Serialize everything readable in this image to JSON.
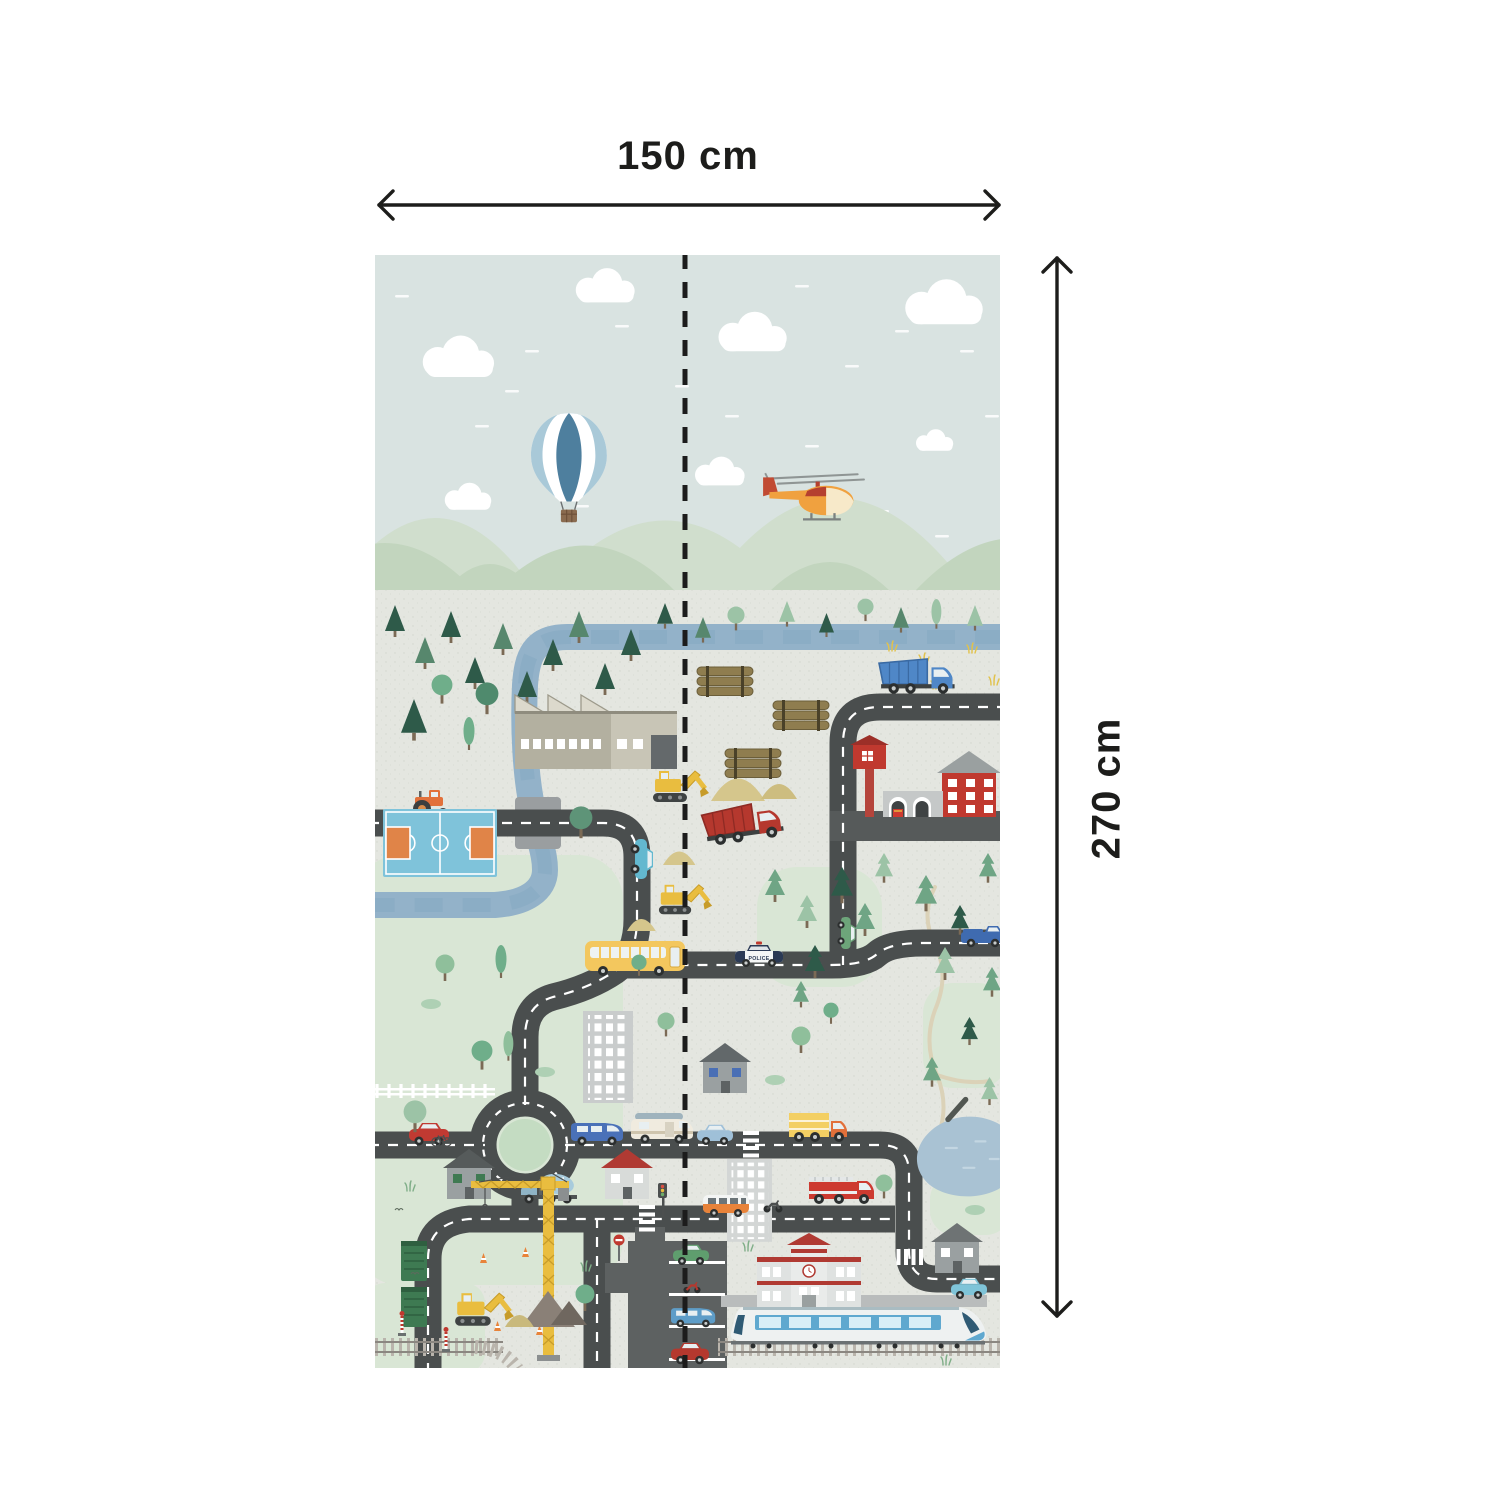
{
  "dimension_annotations": {
    "width_label": "150 cm",
    "height_label": "270 cm",
    "arrow_color": "#1d1d1b"
  },
  "mural": {
    "police_label": "POLICE",
    "palette": {
      "sky": "#d9e3e1",
      "cloud": "#ffffff",
      "mountain-pale": "#d0decd",
      "mountain-mid": "#c2d5be",
      "ground": "#e4e6e0",
      "grass-patch": "#d9e6d5",
      "river": "#93b2c9",
      "river-streak": "#7fa3bd",
      "road": "#4a4e4e",
      "road-line": "#ffffff",
      "plaza": "#5d6161",
      "street": "#565a5a",
      "bridge": "#9a9ea0",
      "rail-tie": "#b9b4ac",
      "rail": "#8b8781",
      "platform": "#b9bcbc",
      "dirt-path": "#dbd2b8",
      "fold-line": "#1c1c1c"
    },
    "scene": [
      {
        "n": "cloud",
        "s": "cloud",
        "x": 42,
        "y": 84,
        "sc": 1.15
      },
      {
        "n": "cloud",
        "s": "cloud",
        "x": 196,
        "y": 16,
        "sc": 0.95
      },
      {
        "n": "cloud",
        "s": "cloud",
        "x": 338,
        "y": 60,
        "sc": 1.1
      },
      {
        "n": "cloud",
        "s": "cloud",
        "x": 524,
        "y": 28,
        "sc": 1.25
      },
      {
        "n": "cloud",
        "s": "cloud",
        "x": 66,
        "y": 230,
        "sc": 0.75
      },
      {
        "n": "cloud",
        "s": "cloud",
        "x": 316,
        "y": 204,
        "sc": 0.8
      },
      {
        "n": "cloud",
        "s": "cloud",
        "x": 538,
        "y": 176,
        "sc": 0.6
      },
      {
        "n": "hot-air-balloon",
        "s": "balloon",
        "x": 156,
        "y": 158,
        "sc": 1.15
      },
      {
        "n": "helicopter",
        "s": "heli",
        "x": 386,
        "y": 214,
        "sc": 1.05
      },
      {
        "n": "pine-tree",
        "s": "pine",
        "x": 10,
        "y": 350
      },
      {
        "n": "pine-tree",
        "s": "pine",
        "x": 40,
        "y": 382,
        "c1": "#57876d"
      },
      {
        "n": "pine-tree",
        "s": "pine",
        "x": 66,
        "y": 356
      },
      {
        "n": "pine-tree",
        "s": "pine",
        "x": 90,
        "y": 402
      },
      {
        "n": "pine-tree",
        "s": "pine",
        "x": 118,
        "y": 368,
        "c1": "#57876d"
      },
      {
        "n": "pine-tree",
        "s": "pine",
        "x": 142,
        "y": 416
      },
      {
        "n": "pine-tree",
        "s": "pine",
        "x": 168,
        "y": 384
      },
      {
        "n": "pine-tree",
        "s": "pine",
        "x": 194,
        "y": 356,
        "c1": "#57876d"
      },
      {
        "n": "pine-tree",
        "s": "pine",
        "x": 220,
        "y": 408
      },
      {
        "n": "pine-tree",
        "s": "pine",
        "x": 246,
        "y": 374
      },
      {
        "n": "pine-tree",
        "s": "pine",
        "x": 26,
        "y": 444,
        "sc": 1.3
      },
      {
        "n": "pine-tree",
        "s": "pine",
        "x": 148,
        "y": 466,
        "sc": 1.3
      },
      {
        "n": "pine-tree",
        "s": "pine",
        "x": 238,
        "y": 466,
        "sc": 1.2
      },
      {
        "n": "pine-tree",
        "s": "pine",
        "x": 204,
        "y": 452,
        "c1": "#57876d"
      },
      {
        "n": "round-tree",
        "s": "tree",
        "x": 56,
        "y": 420,
        "c1": "#6fae8a",
        "sc": 1.1
      },
      {
        "n": "round-tree",
        "s": "tree",
        "x": 100,
        "y": 428,
        "c1": "#4f8a6d",
        "sc": 1.2
      },
      {
        "n": "cypress-tree",
        "s": "cypress",
        "x": 88,
        "y": 462
      },
      {
        "n": "pine-tree",
        "s": "pine",
        "x": 282,
        "y": 348,
        "sc": 0.8
      },
      {
        "n": "pine-tree",
        "s": "pine",
        "x": 320,
        "y": 362,
        "sc": 0.8,
        "c1": "#57876d"
      },
      {
        "n": "round-tree",
        "s": "tree",
        "x": 352,
        "y": 352,
        "c1": "#9cc3a6",
        "sc": 0.9
      },
      {
        "n": "pine-tree",
        "s": "pine",
        "x": 404,
        "y": 346,
        "sc": 0.8,
        "c1": "#9cc3a6"
      },
      {
        "n": "pine-tree",
        "s": "pine",
        "x": 444,
        "y": 358,
        "sc": 0.75
      },
      {
        "n": "round-tree",
        "s": "tree",
        "x": 482,
        "y": 344,
        "c1": "#9cc3a6",
        "sc": 0.85
      },
      {
        "n": "pine-tree",
        "s": "pine",
        "x": 518,
        "y": 352,
        "sc": 0.8,
        "c1": "#57876d"
      },
      {
        "n": "cypress-tree",
        "s": "cypress",
        "x": 556,
        "y": 344,
        "sc": 0.9,
        "c1": "#9cc3a6"
      },
      {
        "n": "pine-tree",
        "s": "pine",
        "x": 592,
        "y": 350,
        "sc": 0.8,
        "c1": "#9cc3a6"
      },
      {
        "n": "wheat-tuft",
        "s": "grass",
        "x": 512,
        "y": 386,
        "c1": "#e2c24a"
      },
      {
        "n": "wheat-tuft",
        "s": "grass",
        "x": 544,
        "y": 398,
        "c1": "#e2c24a"
      },
      {
        "n": "wheat-tuft",
        "s": "grass",
        "x": 592,
        "y": 388,
        "c1": "#e2c24a"
      },
      {
        "n": "wheat-tuft",
        "s": "grass",
        "x": 614,
        "y": 420,
        "c1": "#e2c24a"
      },
      {
        "n": "wheat-tuft",
        "s": "grass",
        "x": 556,
        "y": 424,
        "c1": "#e2c24a"
      },
      {
        "n": "factory",
        "s": "factory",
        "x": 140,
        "y": 428
      },
      {
        "n": "log-pile",
        "s": "logs",
        "x": 322,
        "y": 412
      },
      {
        "n": "log-pile",
        "s": "logs",
        "x": 398,
        "y": 446
      },
      {
        "n": "log-pile",
        "s": "logs",
        "x": 350,
        "y": 494
      },
      {
        "n": "dump-truck-blue",
        "s": "dumptruck",
        "x": 504,
        "y": 404,
        "sc": 1.05,
        "c1": "#4f87c7",
        "c2": "#3a6aa3"
      },
      {
        "n": "tractor",
        "s": "tractor",
        "x": 36,
        "y": 536
      },
      {
        "n": "fire-station",
        "s": "firestation",
        "x": 470,
        "y": 484
      },
      {
        "n": "backhoe-loader",
        "s": "excavator",
        "x": 276,
        "y": 512
      },
      {
        "n": "sand-pile",
        "s": "sand",
        "x": 336,
        "y": 516,
        "sc": 1.5,
        "c1": "#d5c68c"
      },
      {
        "n": "sand-pile",
        "s": "sand",
        "x": 386,
        "y": 524,
        "c1": "#cdbd80"
      },
      {
        "n": "dump-truck-red",
        "s": "dumptruck",
        "x": 326,
        "y": 556,
        "r": -8,
        "sc": 1.1,
        "c1": "#b5382e",
        "c2": "#8e2b24"
      },
      {
        "n": "sand-pile",
        "s": "sand",
        "x": 288,
        "y": 592,
        "sc": 0.9,
        "c1": "#d5c68c"
      },
      {
        "n": "excavator",
        "s": "excavator",
        "x": 282,
        "y": 626,
        "sc": 0.95
      },
      {
        "n": "sand-pile",
        "s": "sand",
        "x": 252,
        "y": 660,
        "sc": 0.8,
        "c1": "#d5c68c"
      },
      {
        "n": "basketball-court",
        "s": "court",
        "x": 8,
        "y": 554
      },
      {
        "n": "round-tree",
        "s": "tree",
        "x": 194,
        "y": 552,
        "c1": "#5e9478",
        "sc": 1.2
      },
      {
        "n": "car-teal",
        "s": "car",
        "x": 280,
        "y": 584,
        "r": 90,
        "c1": "#63b8cf"
      },
      {
        "n": "cypress-tree",
        "s": "cypress",
        "x": 120,
        "y": 690,
        "c1": "#6fae8a"
      },
      {
        "n": "round-tree",
        "s": "tree",
        "x": 60,
        "y": 700,
        "c1": "#8fbf9b"
      },
      {
        "n": "pine-tree",
        "s": "pine2",
        "x": 390,
        "y": 614,
        "c1": "#6fa585"
      },
      {
        "n": "pine-tree",
        "s": "pine2",
        "x": 422,
        "y": 640,
        "c1": "#9cc3a6"
      },
      {
        "n": "pine-tree",
        "s": "pine2",
        "x": 456,
        "y": 612,
        "c1": "#2e5a49",
        "sc": 1.1
      },
      {
        "n": "pine-tree",
        "s": "pine2",
        "x": 480,
        "y": 648,
        "c1": "#6fa585"
      },
      {
        "n": "pine-tree",
        "s": "pine2",
        "x": 430,
        "y": 690,
        "c1": "#2e5a49"
      },
      {
        "n": "pine-tree",
        "s": "pine2",
        "x": 500,
        "y": 598,
        "c1": "#9cc3a6",
        "sc": 0.9
      },
      {
        "n": "pine-tree",
        "s": "pine2",
        "x": 540,
        "y": 620,
        "c1": "#6fa585",
        "sc": 1.1
      },
      {
        "n": "pine-tree",
        "s": "pine2",
        "x": 576,
        "y": 650,
        "c1": "#2e5a49",
        "sc": 0.9
      },
      {
        "n": "pine-tree",
        "s": "pine2",
        "x": 604,
        "y": 598,
        "c1": "#6fa585",
        "sc": 0.9
      },
      {
        "n": "pine-tree",
        "s": "pine2",
        "x": 560,
        "y": 692,
        "c1": "#9cc3a6"
      },
      {
        "n": "pine-tree",
        "s": "pine2",
        "x": 608,
        "y": 712,
        "c1": "#6fa585",
        "sc": 0.9
      },
      {
        "n": "pine-tree",
        "s": "pine2",
        "x": 586,
        "y": 762,
        "c1": "#2e5a49",
        "sc": 0.85
      },
      {
        "n": "pine-tree",
        "s": "pine2",
        "x": 548,
        "y": 802,
        "c1": "#6fa585",
        "sc": 0.9
      },
      {
        "n": "pine-tree",
        "s": "pine2",
        "x": 606,
        "y": 822,
        "c1": "#9cc3a6",
        "sc": 0.85
      },
      {
        "n": "pine-tree",
        "s": "pine2",
        "x": 418,
        "y": 726,
        "c1": "#6fa585",
        "sc": 0.8
      },
      {
        "n": "school-bus",
        "s": "bus",
        "x": 210,
        "y": 686
      },
      {
        "n": "police-car",
        "s": "police",
        "x": 360,
        "y": 688
      },
      {
        "n": "pickup-truck-blue",
        "s": "pickup",
        "x": 586,
        "y": 668,
        "c1": "#3f6bb0"
      },
      {
        "n": "mini-van-green",
        "s": "car",
        "x": 482,
        "y": 662,
        "r": 90,
        "c1": "#6da57a",
        "sc": 0.8
      },
      {
        "n": "office-building",
        "s": "office",
        "x": 208,
        "y": 756,
        "c1": "#c9cccc"
      },
      {
        "n": "house-blue-windows",
        "s": "house",
        "x": 324,
        "y": 788,
        "c1": "#9aa0a1",
        "c2": "#62686a",
        "c3": "#4a6fb5"
      },
      {
        "n": "round-tree",
        "s": "tree",
        "x": 282,
        "y": 758,
        "c1": "#8fbf9b",
        "sc": 0.9
      },
      {
        "n": "round-tree",
        "s": "tree",
        "x": 256,
        "y": 700,
        "c1": "#6fae8a",
        "sc": 0.8
      },
      {
        "n": "bush",
        "s": "bush",
        "x": 390,
        "y": 820
      },
      {
        "n": "round-tree",
        "s": "tree",
        "x": 416,
        "y": 772,
        "c1": "#8fbf9b"
      },
      {
        "n": "round-tree",
        "s": "tree",
        "x": 448,
        "y": 748,
        "c1": "#6fae8a",
        "sc": 0.8
      },
      {
        "n": "picket-fence",
        "s": "fence",
        "x": 0,
        "y": 828
      },
      {
        "n": "round-tree",
        "s": "tree",
        "x": 96,
        "y": 786,
        "c1": "#6fae8a",
        "sc": 1.1
      },
      {
        "n": "cypress-tree",
        "s": "cypress",
        "x": 128,
        "y": 776,
        "c1": "#8fbf9b",
        "sc": 0.9
      },
      {
        "n": "car-red",
        "s": "car",
        "x": 34,
        "y": 866,
        "c1": "#c13a32"
      },
      {
        "n": "van-blue",
        "s": "van",
        "x": 196,
        "y": 862,
        "c1": "#4a71b8"
      },
      {
        "n": "camper-van",
        "s": "camper",
        "x": 256,
        "y": 856
      },
      {
        "n": "car-light-blue",
        "s": "car",
        "x": 322,
        "y": 868,
        "c1": "#9fc0d8",
        "sc": 0.9
      },
      {
        "n": "crosswalk",
        "s": "zebra",
        "x": 368,
        "y": 876
      },
      {
        "n": "box-truck-yellow",
        "s": "boxtruck",
        "x": 414,
        "y": 856,
        "c1": "#f3cf63",
        "c2": "#e2703a"
      },
      {
        "n": "office-building-tall",
        "s": "office",
        "x": 352,
        "y": 904,
        "c1": "#d3d6d5",
        "sc": 0.9
      },
      {
        "n": "pond",
        "s": "pond",
        "x": 540,
        "y": 860,
        "sc": 1.1
      },
      {
        "n": "round-tree",
        "s": "tree",
        "x": 500,
        "y": 920,
        "c1": "#8fbf9b",
        "sc": 0.9
      },
      {
        "n": "house-green-windows",
        "s": "house",
        "x": 68,
        "y": 894,
        "c1": "#9aa0a1",
        "c2": "#565b5b",
        "c3": "#3f7a52"
      },
      {
        "n": "bicycle",
        "s": "bicycle",
        "x": 56,
        "y": 878
      },
      {
        "n": "apple-tree",
        "s": "tree",
        "x": 28,
        "y": 846,
        "c1": "#9cc3a6",
        "sc": 1.2
      },
      {
        "n": "cement-mixer-truck",
        "s": "mixer",
        "x": 146,
        "y": 918
      },
      {
        "n": "house-red-roof",
        "s": "house",
        "x": 226,
        "y": 894,
        "c1": "#d8dbd9",
        "c2": "#b03a33",
        "c3": "#ffffff"
      },
      {
        "n": "traffic-light",
        "s": "tlight",
        "x": 282,
        "y": 928
      },
      {
        "n": "crosswalk",
        "s": "zebra",
        "x": 264,
        "y": 950
      },
      {
        "n": "minibus-orange",
        "s": "minibus",
        "x": 328,
        "y": 938
      },
      {
        "n": "motorcycle",
        "s": "moto",
        "x": 388,
        "y": 944
      },
      {
        "n": "fire-truck",
        "s": "firetruck",
        "x": 434,
        "y": 920
      },
      {
        "n": "no-entry-sign",
        "s": "noentry",
        "x": 238,
        "y": 980
      },
      {
        "n": "dumpster-green",
        "s": "dumpster",
        "x": 26,
        "y": 986
      },
      {
        "n": "tower-crane",
        "s": "crane",
        "x": 96,
        "y": 916
      },
      {
        "n": "traffic-cone",
        "s": "cone",
        "x": 104,
        "y": 998
      },
      {
        "n": "traffic-cone",
        "s": "cone",
        "x": 146,
        "y": 992
      },
      {
        "n": "traffic-cone",
        "s": "cone",
        "x": 118,
        "y": 1066
      },
      {
        "n": "traffic-cone",
        "s": "cone",
        "x": 160,
        "y": 1070
      },
      {
        "n": "backhoe-loader",
        "s": "excavator",
        "x": 78,
        "y": 1034,
        "sc": 1.05
      },
      {
        "n": "sand-pile-dark",
        "s": "sandtri",
        "x": 146,
        "y": 1036,
        "sc": 1.5,
        "c1": "#8a8077"
      },
      {
        "n": "sand-pile-dark",
        "s": "sandtri",
        "x": 176,
        "y": 1046,
        "c1": "#6f675f"
      },
      {
        "n": "sand-pile",
        "s": "sand",
        "x": 130,
        "y": 1056,
        "sc": 0.8,
        "c1": "#c9b97c"
      },
      {
        "n": "railroad-signal",
        "s": "railsignal",
        "x": 22,
        "y": 1056
      },
      {
        "n": "railroad-signal",
        "s": "railsignal",
        "x": 66,
        "y": 1072
      },
      {
        "n": "parking-lines",
        "s": "parklines",
        "x": 294,
        "y": 1006
      },
      {
        "n": "car-green-parked",
        "s": "car",
        "x": 298,
        "y": 988,
        "c1": "#5f9e6e",
        "sc": 0.9
      },
      {
        "n": "motorcycle-parked",
        "s": "moto",
        "x": 308,
        "y": 1026,
        "c1": "#b5382e",
        "sc": 0.9
      },
      {
        "n": "car-blue-parked",
        "s": "van",
        "x": 296,
        "y": 1048,
        "c1": "#5e9dc8",
        "sc": 0.85
      },
      {
        "n": "car-red-parked",
        "s": "car",
        "x": 296,
        "y": 1086,
        "c1": "#b5382e",
        "sc": 0.95
      },
      {
        "n": "school",
        "s": "school",
        "x": 382,
        "y": 980
      },
      {
        "n": "crosswalk",
        "s": "zebra",
        "x": 548,
        "y": 994,
        "r": 90
      },
      {
        "n": "house-gray",
        "s": "house",
        "x": 556,
        "y": 968,
        "c1": "#9aa0a1",
        "c2": "#6e7374",
        "c3": "#ffffff"
      },
      {
        "n": "car-sky-blue",
        "s": "car",
        "x": 576,
        "y": 1022,
        "c1": "#7fc4d8",
        "sc": 0.9
      },
      {
        "n": "round-tree",
        "s": "tree",
        "x": 200,
        "y": 1030,
        "c1": "#6fae8a"
      },
      {
        "n": "train",
        "s": "train",
        "x": 354,
        "y": 1052
      },
      {
        "n": "bush",
        "s": "bush",
        "x": 46,
        "y": 744
      },
      {
        "n": "bush",
        "s": "bush",
        "x": 160,
        "y": 812
      },
      {
        "n": "bush",
        "s": "bush",
        "x": 590,
        "y": 950
      },
      {
        "n": "grass-tuft",
        "s": "grass",
        "x": 30,
        "y": 926,
        "c1": "#7fae88"
      },
      {
        "n": "grass-tuft",
        "s": "grass",
        "x": 206,
        "y": 1006,
        "c1": "#7fae88"
      },
      {
        "n": "grass-tuft",
        "s": "grass",
        "x": 368,
        "y": 986,
        "c1": "#7fae88"
      },
      {
        "n": "grass-tuft",
        "s": "grass",
        "x": 566,
        "y": 1100,
        "c1": "#7fae88"
      },
      {
        "n": "bird",
        "s": "bird",
        "x": 36,
        "y": 1016
      },
      {
        "n": "bird",
        "s": "bird",
        "x": 20,
        "y": 952
      }
    ]
  }
}
